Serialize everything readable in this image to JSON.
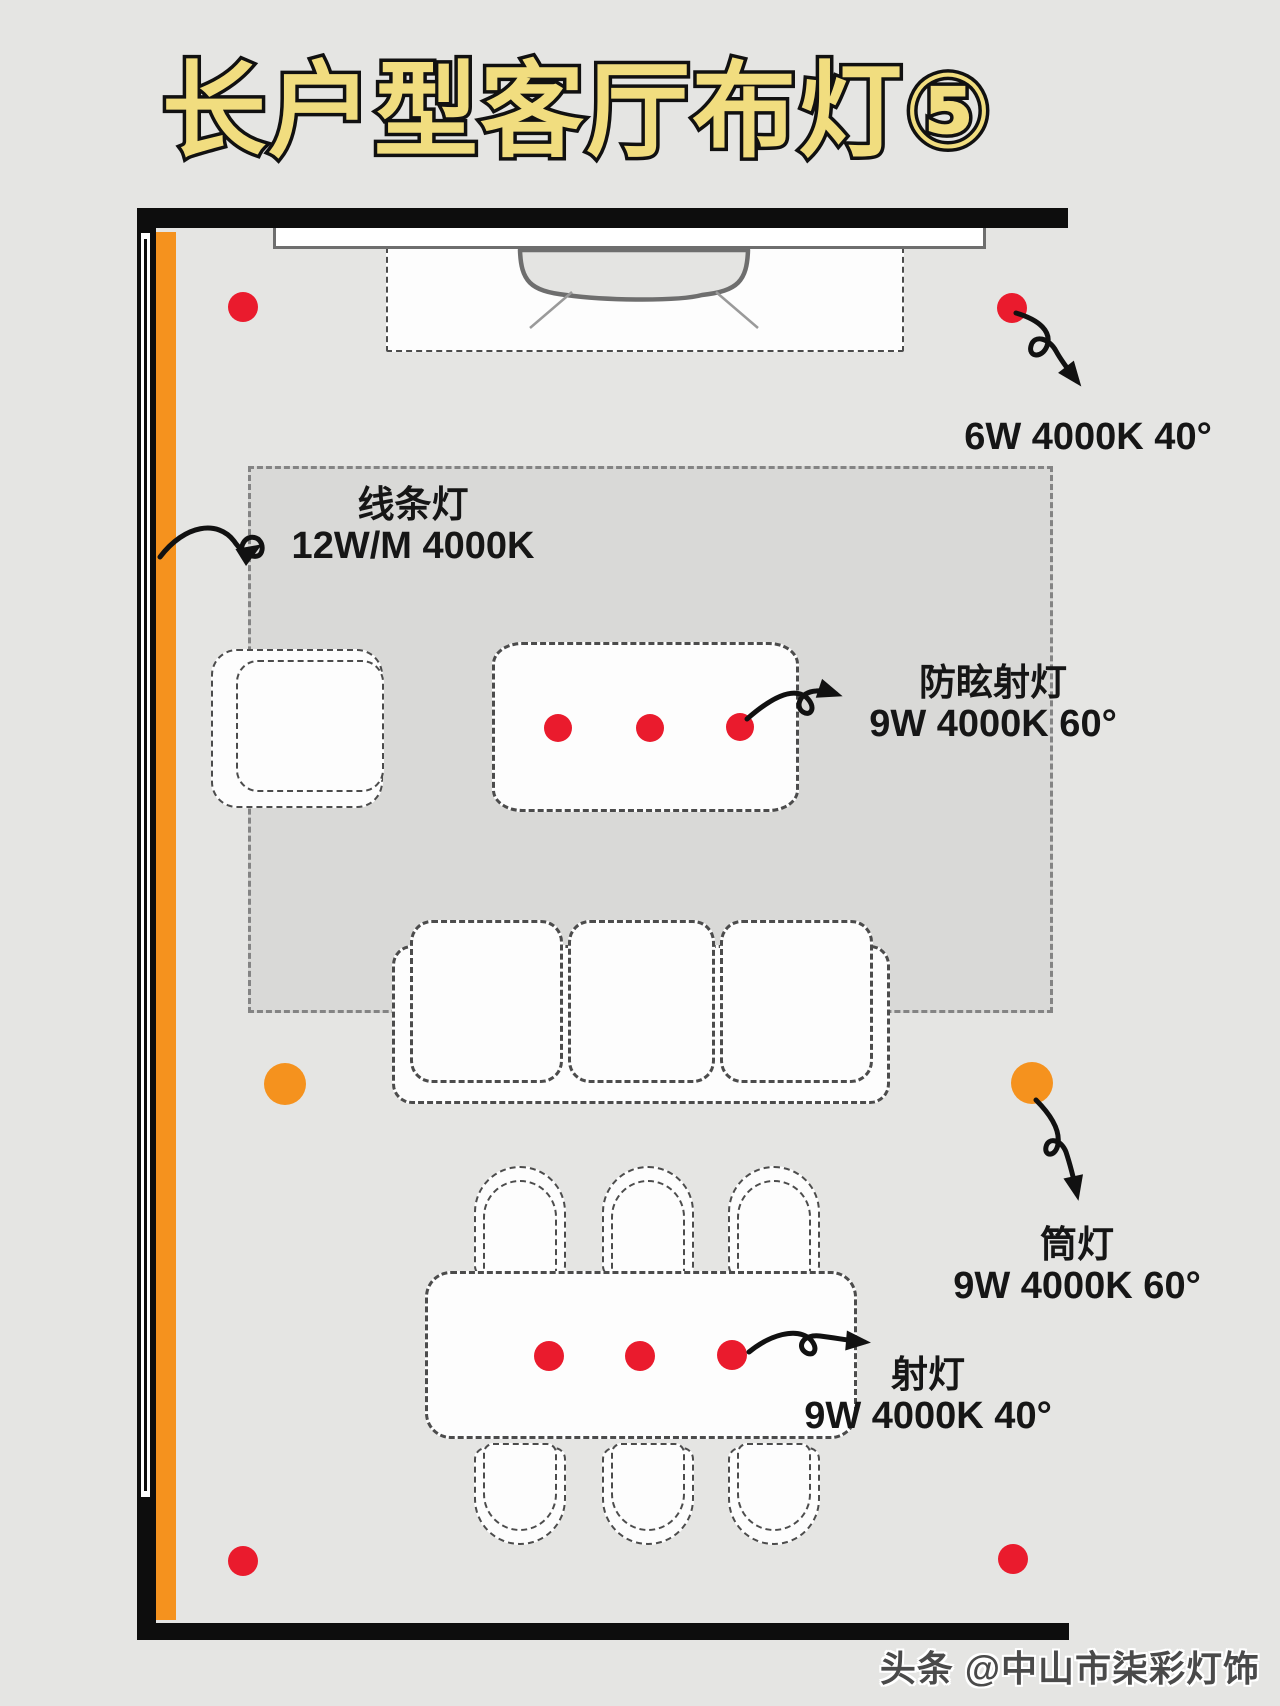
{
  "title": "长户型客厅布灯⑤",
  "watermark": "头条 @中山市柒彩灯饰",
  "legend": {
    "line_light": {
      "name": "线条灯",
      "spec": "12W/M 4000K"
    },
    "tv_wall_spot": {
      "spec": "6W 4000K 40°"
    },
    "anti_glare_spot": {
      "name": "防眩射灯",
      "spec": "9W 4000K 60°"
    },
    "downlight": {
      "name": "筒灯",
      "spec": "9W 4000K 60°"
    },
    "dining_spot": {
      "name": "射灯",
      "spec": "9W 4000K 40°"
    }
  },
  "colors": {
    "accent_red": "#ea1b2d",
    "accent_orange": "#f5921e",
    "title_yellow": "#f1dd7f",
    "background": "#e5e5e3",
    "rug": "#d9d9d7",
    "wall": "#0d0d0d"
  }
}
